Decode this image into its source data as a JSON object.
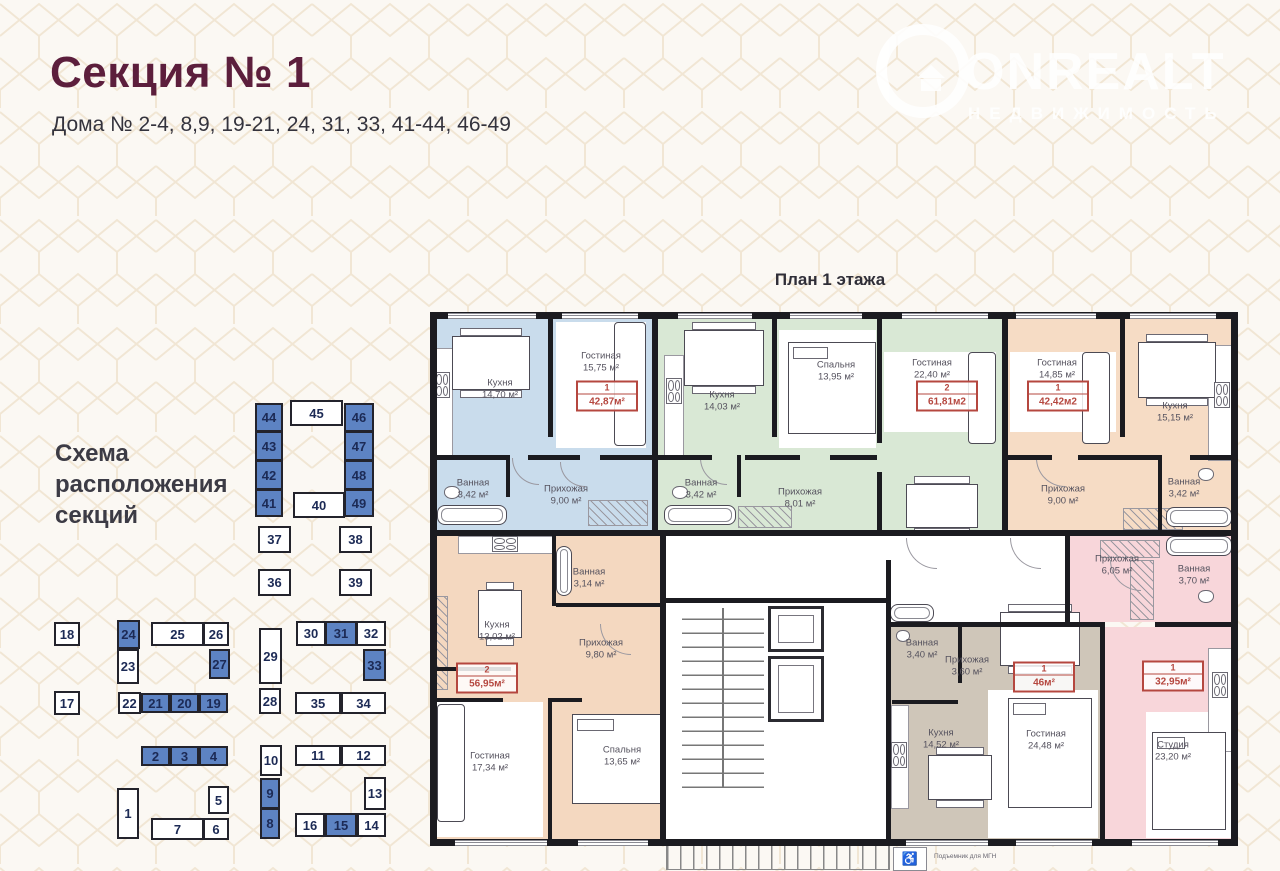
{
  "header": {
    "title": "Секция № 1",
    "subtitle": "Дома № 2-4, 8,9, 19-21, 24, 31, 33, 41-44, 46-49"
  },
  "watermark": {
    "brand": "ONREALT",
    "tagline": "НЕДВИЖИМОСТЬ",
    "icon": "house-in-circle-icon"
  },
  "plan": {
    "title": "План 1 этажа",
    "note": "Подъемник для МГН",
    "wheelchair_icon": "♿"
  },
  "scheme": {
    "label": "Схема расположения секций",
    "highlight_color": "#5d83c3",
    "boxes": [
      {
        "n": "44",
        "hl": true
      },
      {
        "n": "43",
        "hl": true
      },
      {
        "n": "42",
        "hl": true
      },
      {
        "n": "41",
        "hl": true
      },
      {
        "n": "45",
        "hl": false
      },
      {
        "n": "46",
        "hl": true
      },
      {
        "n": "47",
        "hl": true
      },
      {
        "n": "48",
        "hl": true
      },
      {
        "n": "49",
        "hl": true
      },
      {
        "n": "40",
        "hl": false
      },
      {
        "n": "37",
        "hl": false
      },
      {
        "n": "38",
        "hl": false
      },
      {
        "n": "36",
        "hl": false
      },
      {
        "n": "39",
        "hl": false
      },
      {
        "n": "18",
        "hl": false
      },
      {
        "n": "24",
        "hl": true
      },
      {
        "n": "25",
        "hl": false
      },
      {
        "n": "26",
        "hl": false
      },
      {
        "n": "29",
        "hl": false
      },
      {
        "n": "30",
        "hl": false
      },
      {
        "n": "31",
        "hl": true
      },
      {
        "n": "32",
        "hl": false
      },
      {
        "n": "27",
        "hl": true
      },
      {
        "n": "23",
        "hl": false
      },
      {
        "n": "33",
        "hl": true
      },
      {
        "n": "17",
        "hl": false
      },
      {
        "n": "22",
        "hl": false
      },
      {
        "n": "21",
        "hl": true
      },
      {
        "n": "20",
        "hl": true
      },
      {
        "n": "19",
        "hl": true
      },
      {
        "n": "28",
        "hl": false
      },
      {
        "n": "35",
        "hl": false
      },
      {
        "n": "34",
        "hl": false
      },
      {
        "n": "2",
        "hl": true
      },
      {
        "n": "3",
        "hl": true
      },
      {
        "n": "4",
        "hl": true
      },
      {
        "n": "10",
        "hl": false
      },
      {
        "n": "11",
        "hl": false
      },
      {
        "n": "12",
        "hl": false
      },
      {
        "n": "1",
        "hl": false
      },
      {
        "n": "5",
        "hl": false
      },
      {
        "n": "7",
        "hl": false
      },
      {
        "n": "6",
        "hl": false
      },
      {
        "n": "9",
        "hl": true
      },
      {
        "n": "8",
        "hl": true
      },
      {
        "n": "13",
        "hl": false
      },
      {
        "n": "16",
        "hl": false
      },
      {
        "n": "15",
        "hl": true
      },
      {
        "n": "14",
        "hl": false
      }
    ]
  },
  "floor_plan": {
    "apartments": [
      {
        "unit": "1",
        "total_area": "42,87м²",
        "color": "#c9dcec",
        "rooms": [
          {
            "name": "Кухня",
            "area": "14,70 м²"
          },
          {
            "name": "Гостиная",
            "area": "15,75 м²"
          },
          {
            "name": "Ванная",
            "area": "3,42 м²"
          },
          {
            "name": "Прихожая",
            "area": "9,00 м²"
          }
        ]
      },
      {
        "unit": "2",
        "total_area": "61,81м2",
        "color": "#d9e8d5",
        "rooms": [
          {
            "name": "Кухня",
            "area": "14,03 м²"
          },
          {
            "name": "Спальня",
            "area": "13,95 м²"
          },
          {
            "name": "Гостиная",
            "area": "22,40 м²"
          },
          {
            "name": "Ванная",
            "area": "3,42 м²"
          },
          {
            "name": "Прихожая",
            "area": "8,01 м²"
          }
        ]
      },
      {
        "unit": "1",
        "total_area": "42,42м2",
        "color": "#f6dcc5",
        "rooms": [
          {
            "name": "Гостиная",
            "area": "14,85 м²"
          },
          {
            "name": "Прихожая",
            "area": "9,00 м²"
          },
          {
            "name": "Кухня",
            "area": "15,15 м²"
          },
          {
            "name": "Ванная",
            "area": "3,42 м²"
          }
        ]
      },
      {
        "unit": "2",
        "total_area": "56,95м²",
        "color": "#f4d8c0",
        "rooms": [
          {
            "name": "Кухня",
            "area": "13,02 м²"
          },
          {
            "name": "Ванная",
            "area": "3,14 м²"
          },
          {
            "name": "Прихожая",
            "area": "9,80 м²"
          },
          {
            "name": "Гостиная",
            "area": "17,34 м²"
          },
          {
            "name": "Спальня",
            "area": "13,65 м²"
          }
        ]
      },
      {
        "unit": "1",
        "total_area": "46м²",
        "color": "#cfc6b9",
        "rooms": [
          {
            "name": "Ванная",
            "area": "3,40 м²"
          },
          {
            "name": "Прихожая",
            "area": "3,60 м²"
          },
          {
            "name": "Кухня",
            "area": "14,52 м²"
          },
          {
            "name": "Гостиная",
            "area": "24,48 м²"
          }
        ]
      },
      {
        "unit": "1",
        "total_area": "32,95м²",
        "color": "#f8d6da",
        "rooms": [
          {
            "name": "Прихожая",
            "area": "6,05 м²"
          },
          {
            "name": "Ванная",
            "area": "3,70 м²"
          },
          {
            "name": "Студия",
            "area": "23,20 м²"
          }
        ]
      }
    ]
  }
}
